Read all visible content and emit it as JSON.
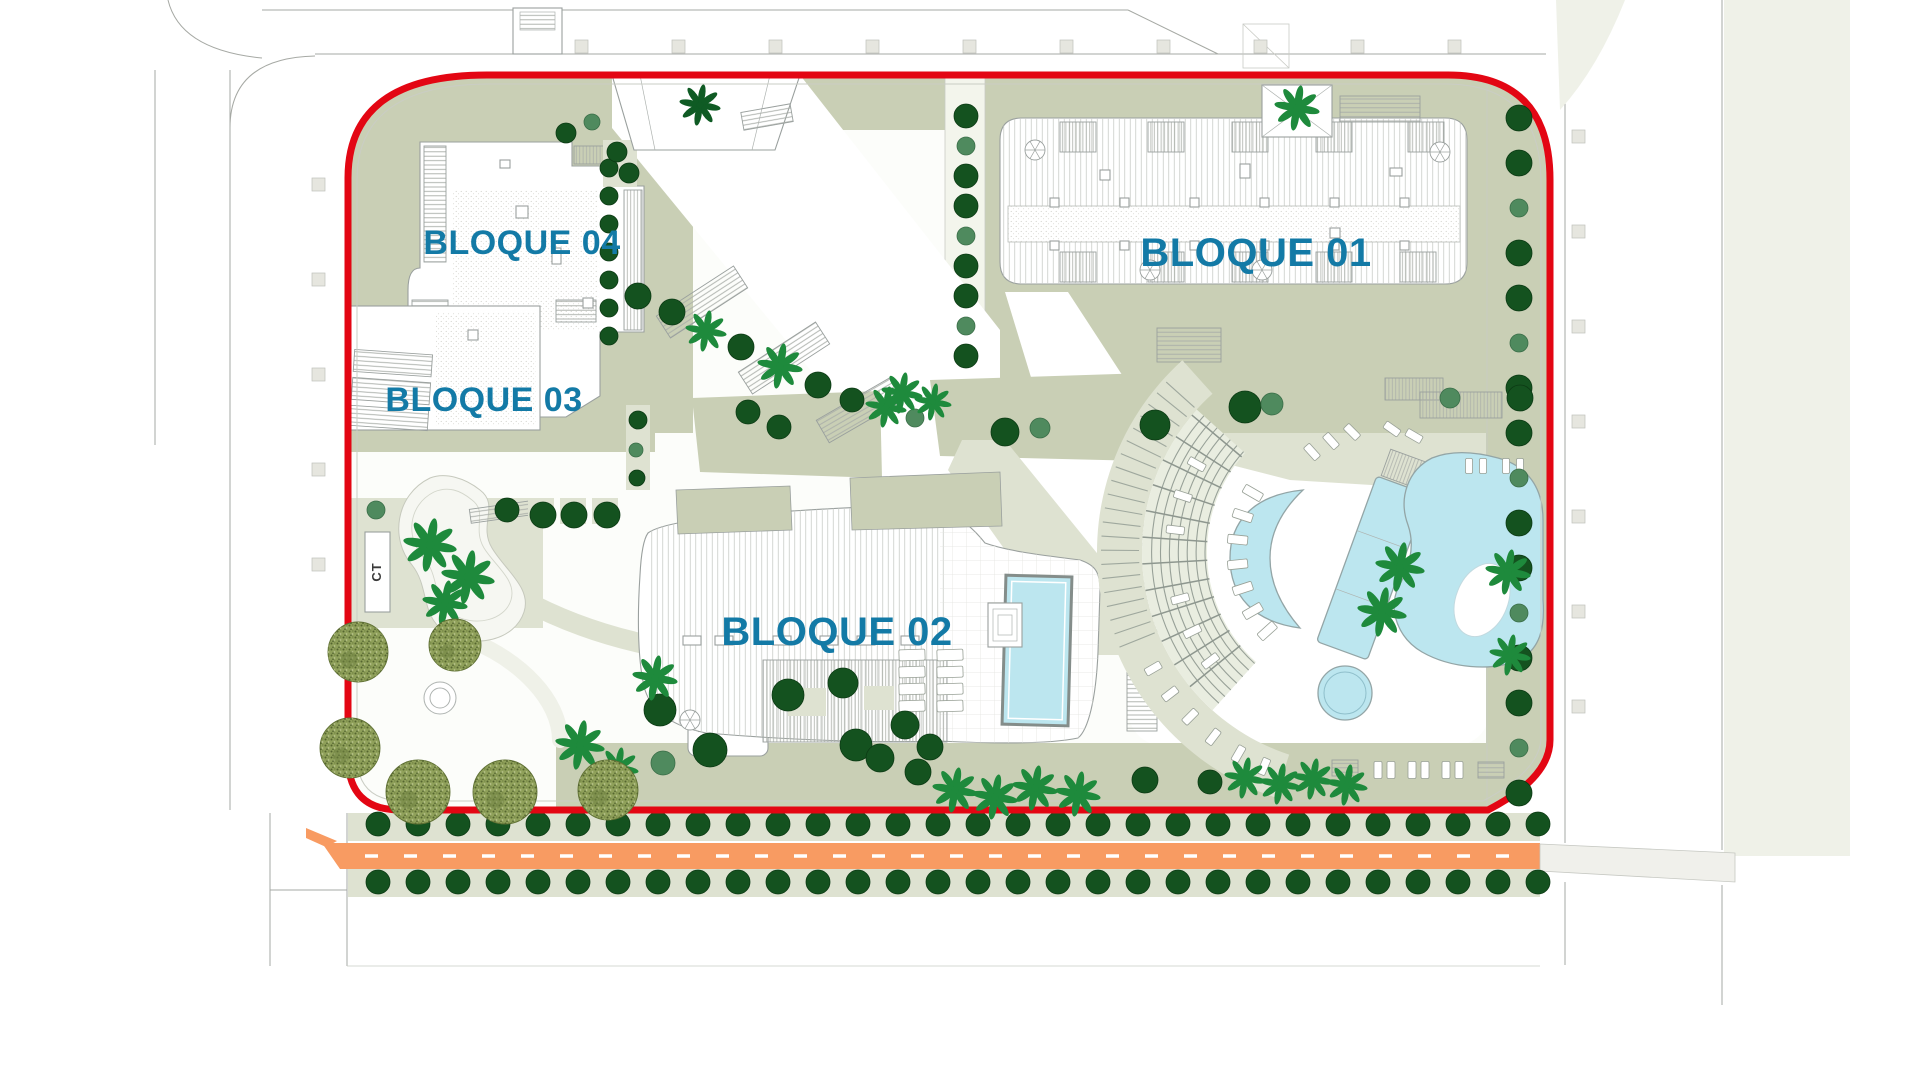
{
  "page": {
    "title": "Residential complex site plan"
  },
  "labels": {
    "block01": "BLOQUE 01",
    "block02": "BLOQUE 02",
    "block03": "BLOQUE 03",
    "block04": "BLOQUE 04",
    "transformer": "CT"
  },
  "colors": {
    "boundary_red": "#E30613",
    "label_blue": "#137AA6",
    "road_orange": "#F89B62",
    "pool_cyan": "#BCE6EF",
    "sage": "#C9CFB5",
    "sage_light": "#DEE2D1",
    "sage_pale": "#EFF1E8",
    "tree_dark": "#14521F",
    "tree_medium": "#4F8A5E",
    "palm_green": "#1E8A3C",
    "palm_dark_green": "#0F5B24",
    "olive_tree": "#8FA05A",
    "drawing_line_gray": "#A6A9A4"
  }
}
